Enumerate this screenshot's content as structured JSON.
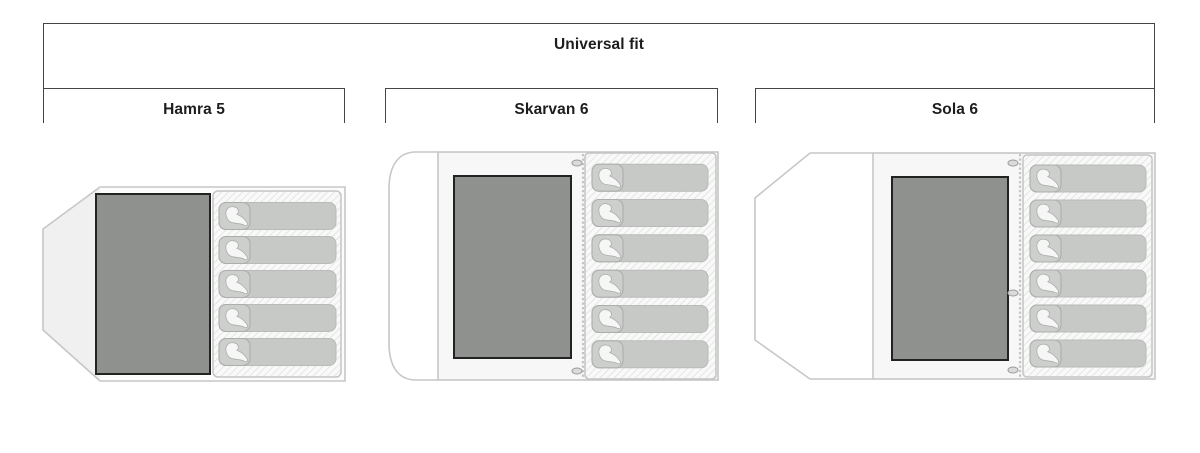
{
  "header": {
    "group_label": "Universal fit"
  },
  "tents": [
    {
      "id": "hamra",
      "label": "Hamra 5",
      "capacity": 5
    },
    {
      "id": "skarvan",
      "label": "Skarvan 6",
      "capacity": 6
    },
    {
      "id": "sola",
      "label": "Sola 6",
      "capacity": 6
    }
  ],
  "colors": {
    "bracket_line": "#454545",
    "label_text": "#1d1d1d",
    "tent_outline": "#c6c7c6",
    "vestibule_fill_hamra": "#eff0ef",
    "vestibule_fill_white": "#ffffff",
    "body_fill": "#f6f7f6",
    "body_fill_hamra": "#fcfcfc",
    "inner_tent_fill": "#8f918f",
    "inner_tent_border": "#222222",
    "hatch_bg": "#f8f9f8",
    "hatch_line": "#d8dad8",
    "panel_border": "#c3c5c3",
    "bag_fill": "#c7c9c7",
    "bag_border": "#b9bbb9",
    "hood_fill": "#cdcfcd",
    "hood_border": "#acaeac",
    "hood_blob": "#f5f6f5",
    "zipper": "#c4c4c4",
    "pull_fill": "#dadada",
    "pull_border": "#9b9b9b"
  }
}
